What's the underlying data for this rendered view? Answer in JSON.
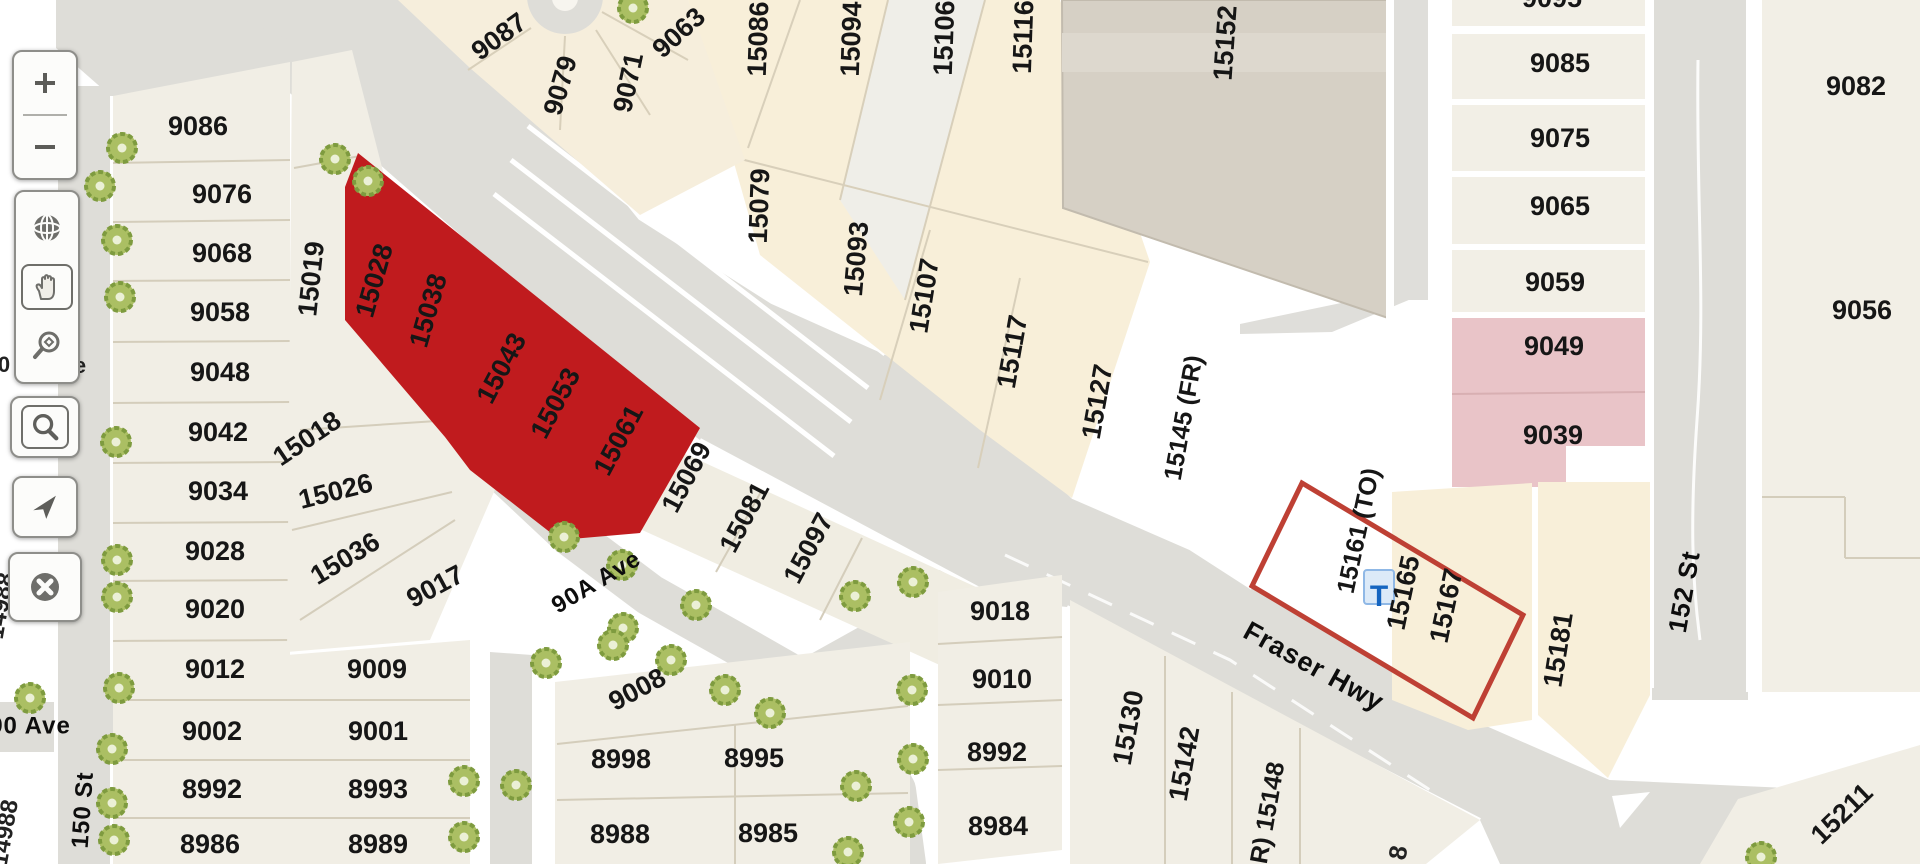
{
  "app": {
    "title": "Parcel map viewer"
  },
  "colors": {
    "road": "#DEDDD8",
    "cream": "#F8EFD9",
    "offwhite": "#F1EEE5",
    "lightlot": "#EFEEE8",
    "building": "#D6D0C5",
    "building_band": "#DDD8CE",
    "pink": "#E9C4C8",
    "highlight_red": "#C01B1E",
    "selection_outline": "#BE4034",
    "tree_fill": "#ABBF63",
    "tree_ring": "#7E9B3F",
    "label_text": "#161616",
    "transit_blue": "#1565C0"
  },
  "map": {
    "highlighted_parcels": [
      "15028",
      "15038",
      "15043",
      "15053",
      "15061"
    ],
    "selected_parcel": {
      "labels": [
        "15161 (TO)",
        "15165",
        "15167"
      ],
      "transit_icon": {
        "t": "T",
        "x": 1379,
        "y": 597
      }
    },
    "labels": {
      "parcels": [
        [
          "9086",
          198,
          128,
          0
        ],
        [
          "9076",
          222,
          196,
          0
        ],
        [
          "9068",
          222,
          255,
          0
        ],
        [
          "9058",
          220,
          314,
          0
        ],
        [
          "9048",
          220,
          374,
          0
        ],
        [
          "9042",
          218,
          434,
          0
        ],
        [
          "9034",
          218,
          493,
          0
        ],
        [
          "9028",
          215,
          553,
          0
        ],
        [
          "9020",
          215,
          611,
          0
        ],
        [
          "9012",
          215,
          671,
          0
        ],
        [
          "9002",
          212,
          733,
          0
        ],
        [
          "8992",
          212,
          791,
          0
        ],
        [
          "8986",
          210,
          846,
          0
        ],
        [
          "15019",
          313,
          279,
          -84
        ],
        [
          "15018",
          308,
          440,
          -34
        ],
        [
          "15026",
          336,
          493,
          -14
        ],
        [
          "15036",
          346,
          560,
          -31
        ],
        [
          "9017",
          436,
          588,
          -28
        ],
        [
          "9009",
          377,
          671,
          0
        ],
        [
          "9001",
          378,
          733,
          0
        ],
        [
          "8993",
          378,
          791,
          0
        ],
        [
          "8989",
          378,
          846,
          0
        ],
        [
          "15028",
          376,
          281,
          -74
        ],
        [
          "15038",
          430,
          311,
          -74
        ],
        [
          "15043",
          503,
          369,
          -62
        ],
        [
          "15053",
          557,
          404,
          -62
        ],
        [
          "15061",
          620,
          441,
          -62
        ],
        [
          "15069",
          688,
          478,
          -62
        ],
        [
          "15081",
          746,
          518,
          -62
        ],
        [
          "15097",
          810,
          549,
          -62
        ],
        [
          "9008",
          638,
          691,
          -28
        ],
        [
          "8998",
          621,
          761,
          0
        ],
        [
          "8995",
          754,
          760,
          0
        ],
        [
          "8988",
          620,
          836,
          0
        ],
        [
          "8985",
          768,
          835,
          0
        ],
        [
          "9087",
          500,
          38,
          -36
        ],
        [
          "9079",
          562,
          86,
          -74
        ],
        [
          "9071",
          630,
          83,
          -78
        ],
        [
          "9063",
          680,
          34,
          -42
        ],
        [
          "15086",
          760,
          39,
          -88
        ],
        [
          "15094",
          853,
          39,
          -88
        ],
        [
          "15106",
          946,
          38,
          -88
        ],
        [
          "15116",
          1025,
          37,
          -88
        ],
        [
          "15079",
          761,
          206,
          -88
        ],
        [
          "15093",
          858,
          259,
          -85
        ],
        [
          "15107",
          926,
          296,
          -81
        ],
        [
          "15117",
          1014,
          352,
          -80
        ],
        [
          "15127",
          1099,
          402,
          -80
        ],
        [
          "15145 (FR)",
          1185,
          418,
          -80,
          25
        ],
        [
          "15152",
          1227,
          43,
          -86
        ],
        [
          "9018",
          1000,
          613,
          0
        ],
        [
          "9010",
          1002,
          681,
          0
        ],
        [
          "8992",
          997,
          754,
          0
        ],
        [
          "8984",
          998,
          828,
          0
        ],
        [
          "15130",
          1130,
          728,
          -80
        ],
        [
          "15142",
          1186,
          764,
          -80
        ],
        [
          "R) 15148",
          1269,
          813,
          -80,
          25
        ],
        [
          "15161 (TO)",
          1360,
          531,
          -78,
          25
        ],
        [
          "15165",
          1405,
          593,
          -78
        ],
        [
          "15167",
          1448,
          606,
          -78
        ],
        [
          "15181",
          1560,
          650,
          -81
        ],
        [
          "15211",
          1843,
          815,
          -44
        ],
        [
          "9095",
          1552,
          0,
          0
        ],
        [
          "9085",
          1560,
          65,
          0
        ],
        [
          "9075",
          1560,
          140,
          0
        ],
        [
          "9065",
          1560,
          208,
          0
        ],
        [
          "9059",
          1555,
          284,
          0
        ],
        [
          "9049",
          1554,
          348,
          0
        ],
        [
          "9039",
          1553,
          437,
          0
        ],
        [
          "9082",
          1856,
          88,
          0
        ],
        [
          "9056",
          1862,
          312,
          0
        ]
      ],
      "streets": [
        [
          "Fraser Hwy",
          1313,
          668,
          29,
          27
        ],
        [
          "90A Ave",
          597,
          583,
          -31,
          24
        ],
        [
          "90 Ave",
          30,
          727,
          0,
          24
        ],
        [
          "150 St",
          84,
          810,
          -86,
          24
        ],
        [
          "152 St",
          1686,
          592,
          -80,
          26
        ]
      ],
      "fragments": [
        [
          "0",
          4,
          366,
          0,
          22
        ],
        [
          "e",
          80,
          367,
          0,
          22
        ],
        [
          "14988",
          2,
          606,
          -80,
          24
        ],
        [
          "14988",
          6,
          833,
          -80,
          24
        ],
        [
          "8",
          1400,
          853,
          -80,
          25
        ]
      ]
    },
    "trees": [
      [
        122,
        148
      ],
      [
        100,
        186
      ],
      [
        117,
        240
      ],
      [
        120,
        297
      ],
      [
        116,
        442
      ],
      [
        117,
        560
      ],
      [
        117,
        597
      ],
      [
        30,
        698
      ],
      [
        119,
        688
      ],
      [
        112,
        749
      ],
      [
        112,
        803
      ],
      [
        114,
        840
      ],
      [
        335,
        159
      ],
      [
        368,
        181
      ],
      [
        633,
        8
      ],
      [
        564,
        537
      ],
      [
        622,
        565
      ],
      [
        623,
        628
      ],
      [
        546,
        663
      ],
      [
        696,
        605
      ],
      [
        671,
        660
      ],
      [
        613,
        645
      ],
      [
        725,
        690
      ],
      [
        770,
        713
      ],
      [
        856,
        786
      ],
      [
        912,
        690
      ],
      [
        913,
        759
      ],
      [
        909,
        822
      ],
      [
        848,
        852
      ],
      [
        464,
        781
      ],
      [
        516,
        785
      ],
      [
        464,
        837
      ],
      [
        855,
        596
      ],
      [
        913,
        582
      ],
      [
        1761,
        857
      ]
    ]
  },
  "toolbar": {
    "buttons": [
      {
        "id": "zoom-in",
        "label": "Zoom in"
      },
      {
        "id": "zoom-out",
        "label": "Zoom out"
      },
      {
        "id": "basemap",
        "label": "Basemap"
      },
      {
        "id": "pan",
        "label": "Pan"
      },
      {
        "id": "zoom-selection",
        "label": "Zoom to selection"
      },
      {
        "id": "search",
        "label": "Search"
      },
      {
        "id": "locate",
        "label": "Locate"
      },
      {
        "id": "clear",
        "label": "Clear"
      }
    ]
  }
}
